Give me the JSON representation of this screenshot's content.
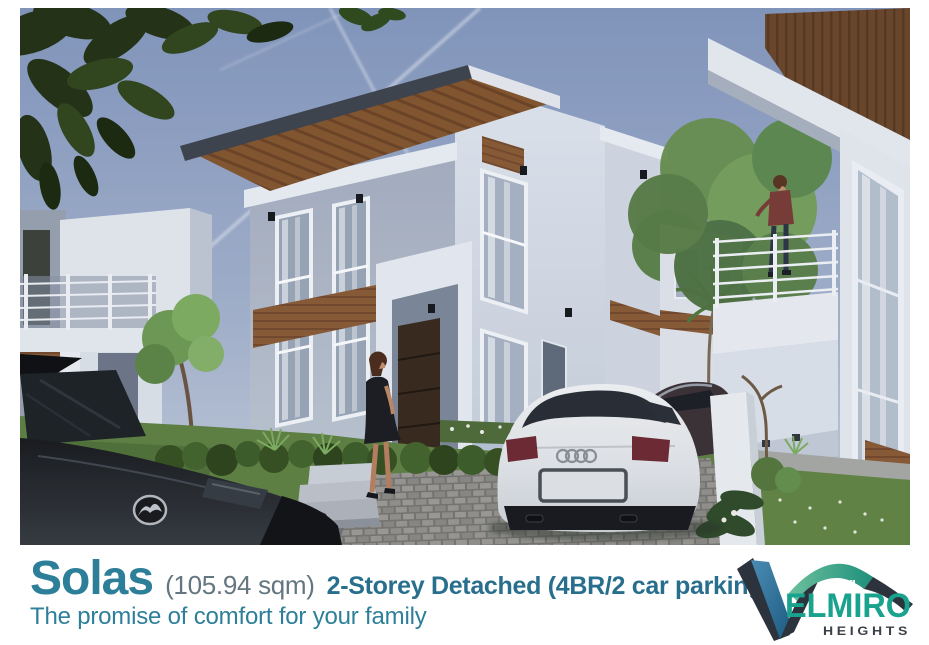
{
  "caption": {
    "title": "Solas",
    "area": "(105.94 sqm)",
    "spec": "2-Storey Detached (4BR/2 car parking)",
    "tagline": "The promise of comfort for your family"
  },
  "logo": {
    "brand": "VELMIRO",
    "wordmark_initial": "V",
    "wordmark_rest": "ELMIRO",
    "subtitle": "HEIGHTS",
    "colors": {
      "green": "#19A28E",
      "dark": "#2C333D",
      "blue": "#2F6F9E"
    }
  },
  "colors": {
    "page_bg": "#FFFFFF",
    "title_teal": "#2D7E99",
    "area_gray": "#64767F",
    "spec_teal": "#286F8D",
    "tagline_teal": "#2E7F9A",
    "sky_top": "#8397BD",
    "sky_bottom": "#C9D1DC",
    "wood_accent": "#8A5A33",
    "lawn_green": "#5F8140"
  },
  "scene": {
    "description": "Dusk 3D architectural rendering: modern white two-storey detached house with wood-slat roof overhang and brown accent panels, neighboring two-storey units on both sides, a woman standing on the front lawn, another woman on an upper balcony, a white sedan with Audi rings and a dark sedan on a cobblestone driveway, a black Mazda car in the left foreground, lawns, hedges, flowering shrubs and trees under a blue evening sky with jet contrails",
    "badges": {
      "white_car": "audi-rings",
      "black_car": "mazda-logo"
    }
  }
}
